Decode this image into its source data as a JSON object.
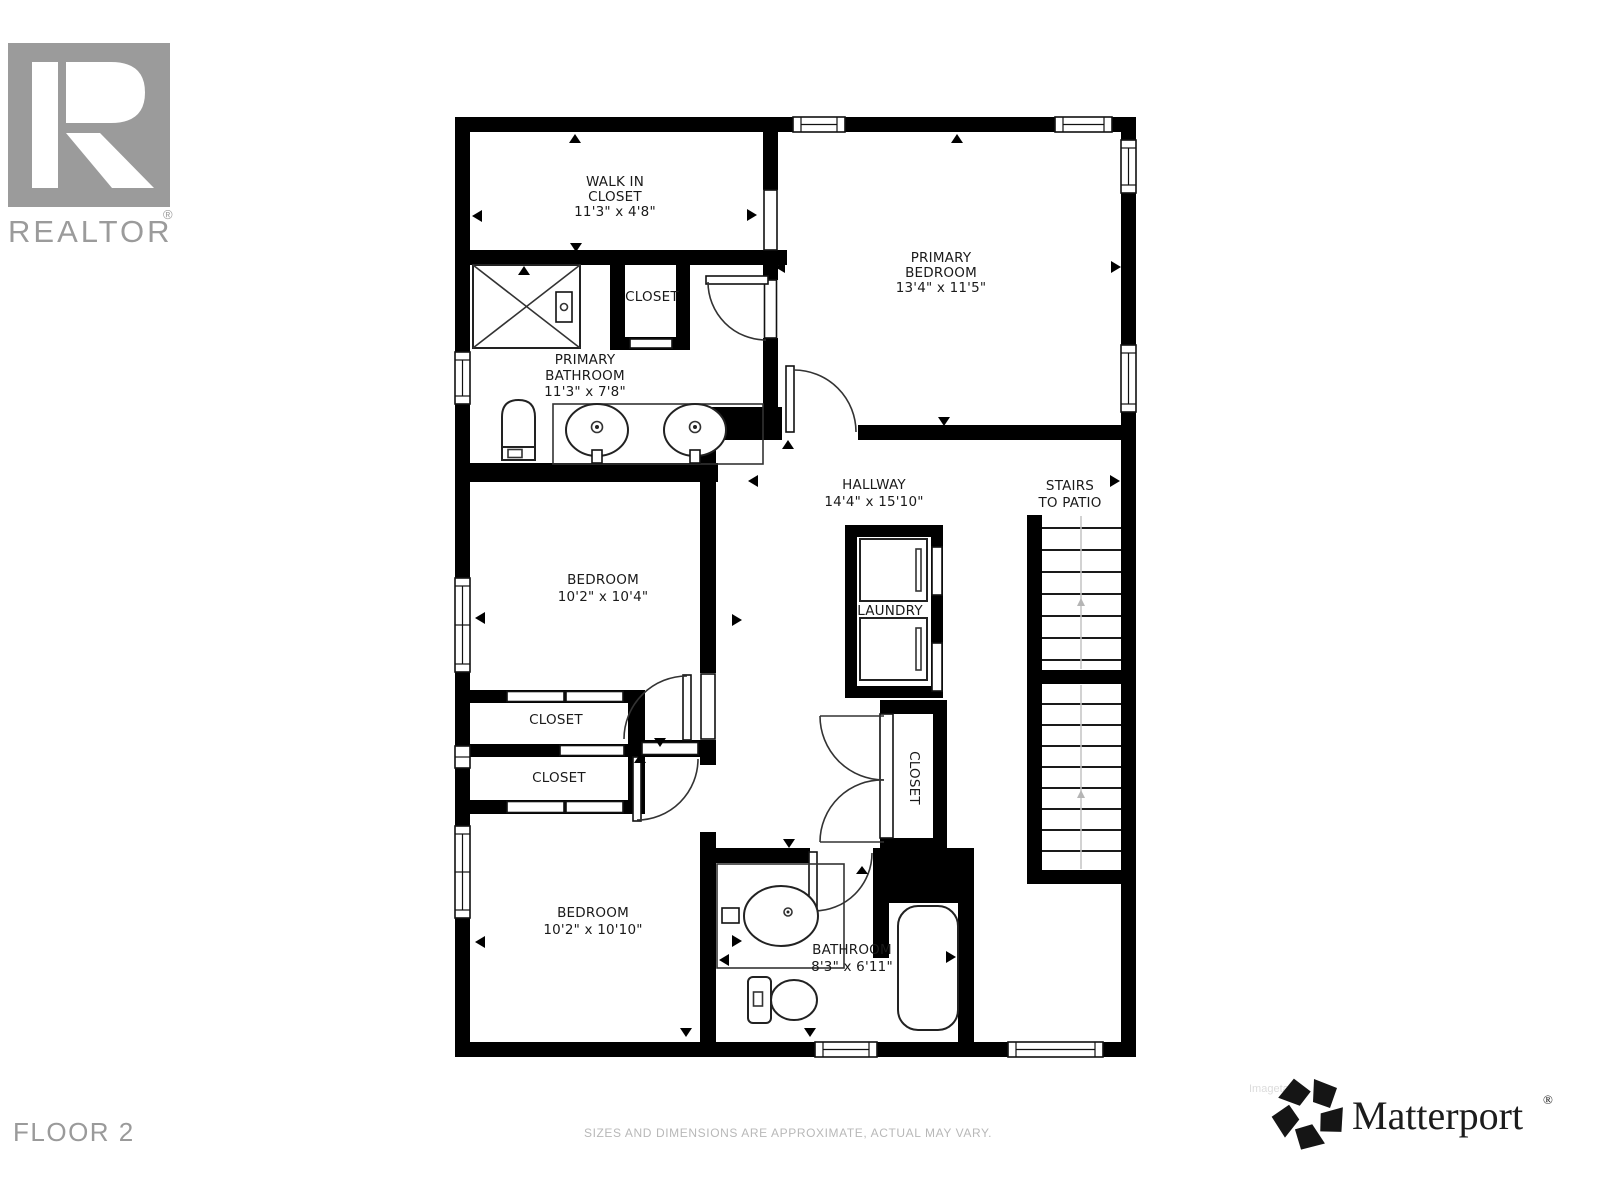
{
  "branding": {
    "realtor": {
      "label": "REALTOR",
      "registered": "®",
      "color": "#9b9b9b"
    },
    "matterport": {
      "label": "Matterport",
      "registered": "®",
      "color": "#1c1c1c",
      "watermark": "Imagetace"
    }
  },
  "footer": {
    "floor_label": "FLOOR 2",
    "disclaimer": "SIZES AND DIMENSIONS ARE APPROXIMATE, ACTUAL MAY VARY."
  },
  "floorplan": {
    "wall_color": "#000000",
    "text_color": "#1a1a1a",
    "rooms": {
      "walk_in_closet": {
        "line1": "WALK IN",
        "line2": "CLOSET",
        "dims": "11'3\" x 4'8\""
      },
      "primary_closet": {
        "label": "CLOSET"
      },
      "primary_bathroom": {
        "line1": "PRIMARY",
        "line2": "BATHROOM",
        "dims": "11'3\" x 7'8\""
      },
      "primary_bedroom": {
        "line1": "PRIMARY",
        "line2": "BEDROOM",
        "dims": "13'4\" x 11'5\""
      },
      "hallway": {
        "line1": "HALLWAY",
        "dims": "14'4\" x 15'10\""
      },
      "stairs": {
        "line1": "STAIRS",
        "line2": "TO PATIO"
      },
      "laundry": {
        "label": "LAUNDRY"
      },
      "bedroom_1": {
        "line1": "BEDROOM",
        "dims": "10'2\" x 10'4\""
      },
      "closet_1": {
        "label": "CLOSET"
      },
      "closet_2": {
        "label": "CLOSET"
      },
      "hall_closet": {
        "label": "CLOSET"
      },
      "bedroom_2": {
        "line1": "BEDROOM",
        "dims": "10'2\" x 10'10\""
      },
      "bathroom": {
        "line1": "BATHROOM",
        "dims": "8'3\" x 6'11\""
      }
    }
  }
}
